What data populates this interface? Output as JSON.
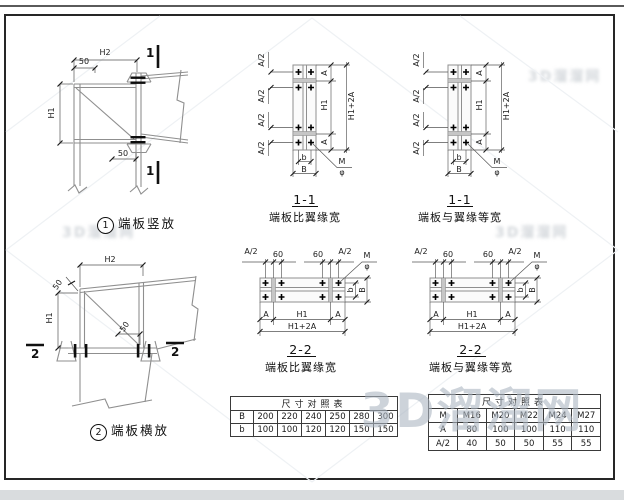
{
  "watermarks": {
    "main": "3D溜溜网"
  },
  "dims": {
    "a_half": "A/2",
    "a": "A",
    "h1": "H1",
    "h1_plus_2a": "H1+2A",
    "b_small": "b",
    "b_big": "B",
    "sixty": "60",
    "bolt_m": "M",
    "phi": "φ"
  },
  "detail_vertical": {
    "badge": "1",
    "caption": "端板竖放",
    "section_mark": "1",
    "dim_h2": "H2",
    "dim_50_top": "50",
    "dim_h1": "H1",
    "dim_50_bottom": "50"
  },
  "detail_horizontal": {
    "badge": "2",
    "caption": "端板横放",
    "section_mark": "2",
    "dim_h2": "H2",
    "dim_50_top": "50",
    "dim_h1": "H1",
    "dim_50_mid": "50"
  },
  "section_1_1_wide": {
    "title": "1-1",
    "subtitle": "端板比翼缘宽"
  },
  "section_1_1_equal": {
    "title": "1-1",
    "subtitle": "端板与翼缘等宽"
  },
  "section_2_2_wide": {
    "title": "2-2",
    "subtitle": "端板比翼缘宽"
  },
  "section_2_2_equal": {
    "title": "2-2",
    "subtitle": "端板与翼缘等宽"
  },
  "size_table": {
    "title": "尺寸对照表",
    "rows": [
      {
        "label": "B",
        "values": [
          "200",
          "220",
          "240",
          "250",
          "280",
          "300"
        ]
      },
      {
        "label": "b",
        "values": [
          "100",
          "100",
          "120",
          "120",
          "150",
          "150"
        ]
      }
    ]
  },
  "bolt_table": {
    "title": "尺寸对照表",
    "rows": [
      {
        "label": "M",
        "values": [
          "M16",
          "M20",
          "M22",
          "M24",
          "M27"
        ]
      },
      {
        "label": "A",
        "values": [
          "80",
          "100",
          "100",
          "110",
          "110"
        ]
      },
      {
        "label": "A/2",
        "values": [
          "40",
          "50",
          "50",
          "55",
          "55"
        ]
      }
    ]
  }
}
